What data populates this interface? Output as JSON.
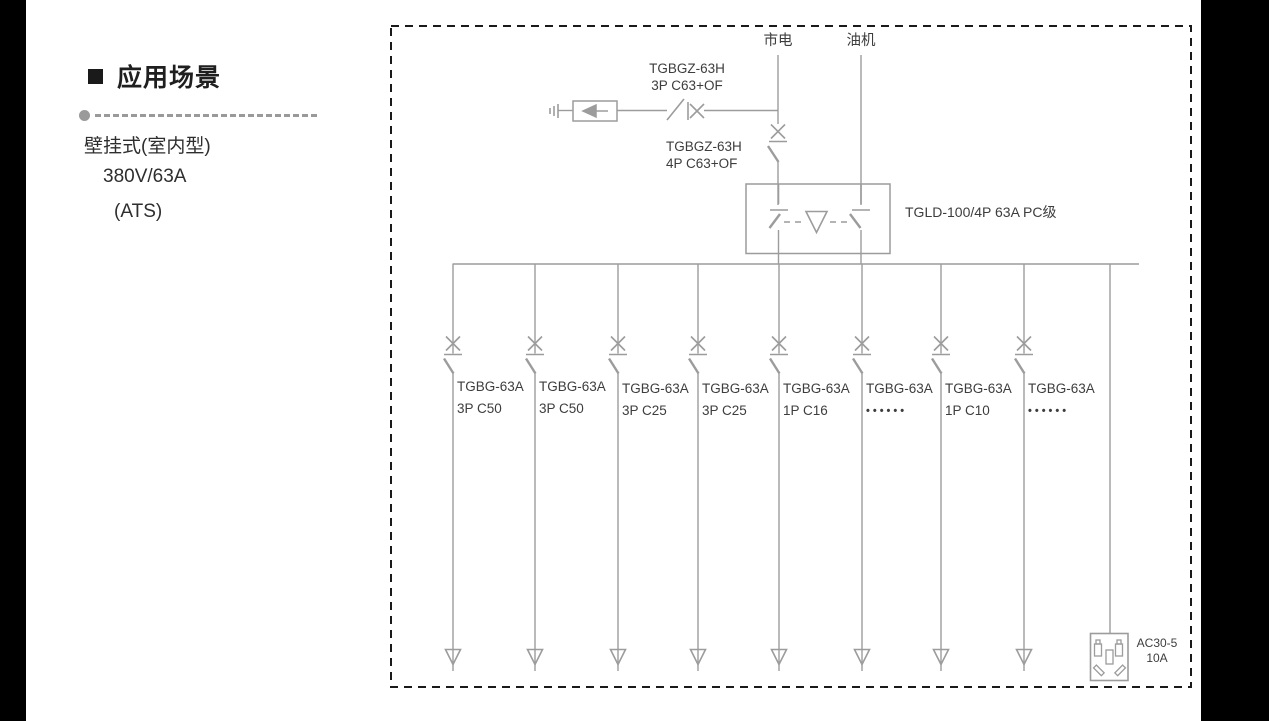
{
  "sidebar": {
    "title": "应用场景",
    "lines": [
      "壁挂式(室内型)",
      "380V/63A",
      "(ATS)"
    ]
  },
  "diagram": {
    "sources": {
      "mains": "市电",
      "generator": "油机"
    },
    "spd_breaker": {
      "model": "TGBGZ-63H",
      "spec": "3P C63+OF"
    },
    "main_breaker": {
      "model": "TGBGZ-63H",
      "spec": "4P C63+OF"
    },
    "ats": {
      "label": "TGLD-100/4P 63A PC级"
    },
    "branches": [
      {
        "model": "TGBG-63A",
        "spec": "3P C50"
      },
      {
        "model": "TGBG-63A",
        "spec": "3P C50"
      },
      {
        "model": "TGBG-63A",
        "spec": "3P C25"
      },
      {
        "model": "TGBG-63A",
        "spec": "3P C25"
      },
      {
        "model": "TGBG-63A",
        "spec": "1P C16"
      },
      {
        "model": "TGBG-63A",
        "spec": "••••••"
      },
      {
        "model": "TGBG-63A",
        "spec": "1P C10"
      },
      {
        "model": "TGBG-63A",
        "spec": "••••••"
      }
    ],
    "socket": {
      "model": "AC30-5",
      "rating": "10A"
    }
  },
  "colors": {
    "line": "#9c9c9c",
    "text": "#3d3d3d",
    "border": "#1a1a1a",
    "side_band": "#000000"
  }
}
